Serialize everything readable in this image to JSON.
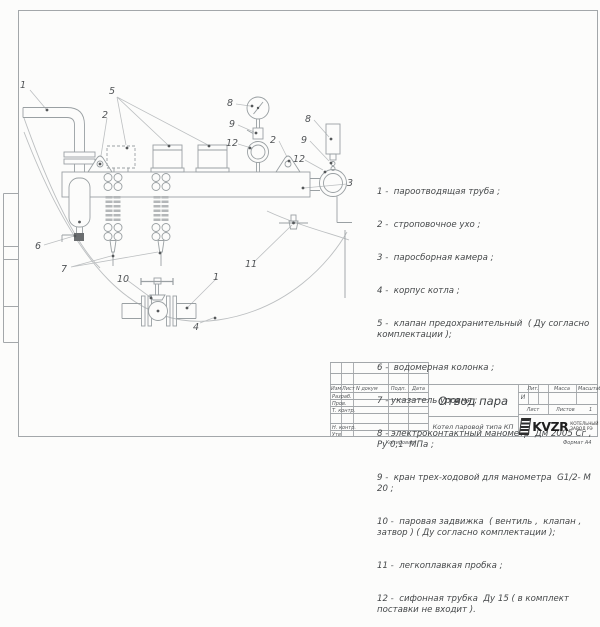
{
  "legend": {
    "items": [
      "1 -  пароотводящая труба ;",
      "2 -  строповочное ухо ;",
      "3 -  паросборная камера ;",
      "4 -  корпус котла ;",
      "5 -  клапан предохранительный  ( Ду согласно комплектации );",
      "6 -  водомерная колонка ;",
      "7 - указатель уровня ;",
      "8 - электроконтактный манометр  Дм 2005 Сг ,  Ру 0,1  МПа ;",
      "9 -  кран трех-ходовой для манометра  G1/2- М 20 ;",
      "10 -  паровая задвижка  ( вентиль ,  клапан , затвор ) ( Ду согласно комплектации );",
      "11 -  легкоплавкая пробка ;",
      "12 -  сифонная трубка  Ду 15 ( в комплект поставки не входит )."
    ]
  },
  "drawing": {
    "callout_labels": {
      "n1": "1",
      "n2": "2",
      "n3": "3",
      "n4": "4",
      "n5": "5",
      "n6": "6",
      "n7": "7",
      "n8": "8",
      "n9": "9",
      "n10": "10",
      "n11": "11",
      "n12": "12"
    }
  },
  "title_block": {
    "doc_title": "Отвод пара",
    "doc_subtitle": "Котел паровой типа КП",
    "col_izm": "Изм",
    "col_list": "Лист",
    "col_dokum": "N докум",
    "col_podp": "Подп.",
    "col_data": "Дата",
    "row_razrab": "Разраб.",
    "row_prov": "Пров.",
    "row_tkontr": "Т. контр.",
    "row_nkontr": "Н. контр.",
    "row_utv": "Утв",
    "lit_label": "Лит.",
    "massa_label": "Масса",
    "masshtab_label": "Масштаб",
    "lit_value": "И",
    "list_label": "Лист",
    "listov_label": "Листов",
    "listov_value": "1",
    "logo_text": "KVZR",
    "logo_caption_1": "КОТЕЛЬНЫЙ",
    "logo_caption_2": "ЗАВОД РЭ"
  },
  "footer": {
    "kopiroval": "Копировал",
    "format_label": "Формат А4"
  }
}
